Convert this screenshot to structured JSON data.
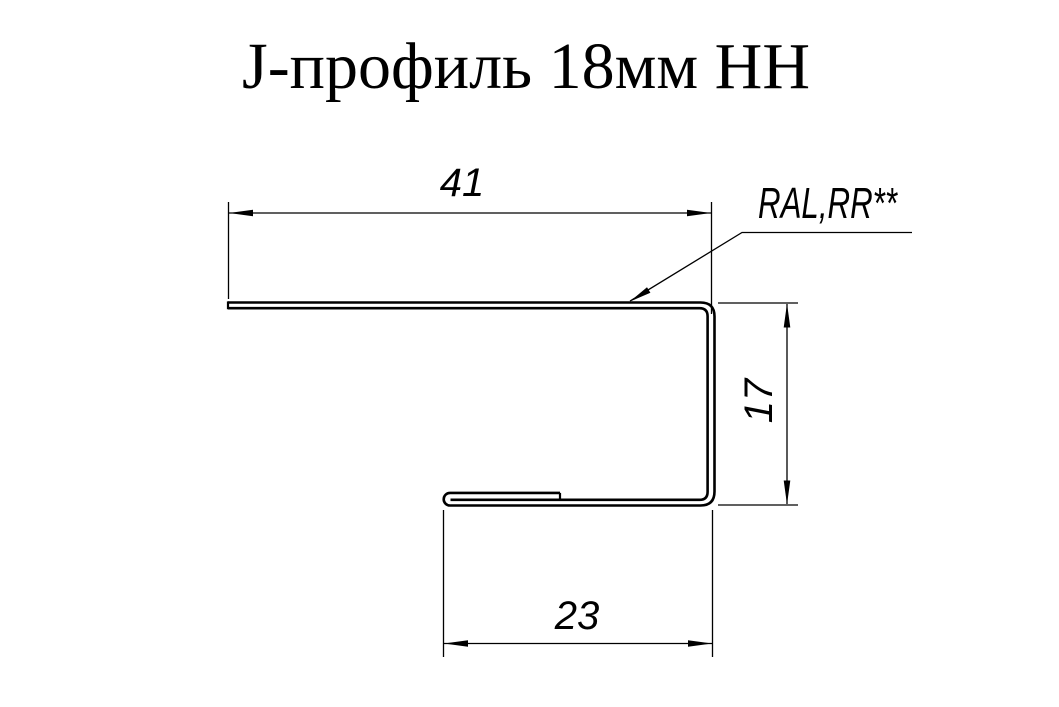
{
  "title": "J-профиль 18мм НН",
  "drawing": {
    "profile_name": "J-profile 18mm sheet metal cross-section",
    "dim_top": {
      "value": "41"
    },
    "dim_right": {
      "value": "17"
    },
    "dim_bottom": {
      "value": "23"
    },
    "leader_label": "RAL,RR**",
    "colors": {
      "line": "#000000",
      "background": "#ffffff"
    }
  }
}
